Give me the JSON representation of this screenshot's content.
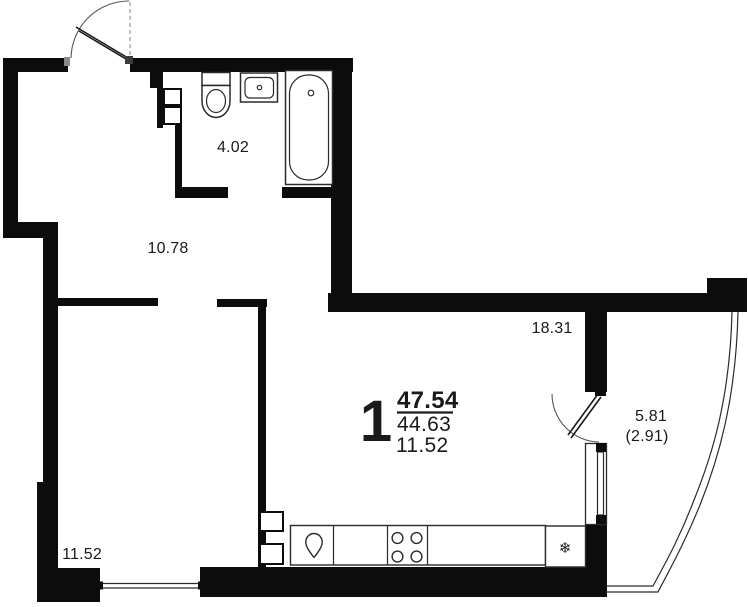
{
  "title": "apartment-floor-plan",
  "colors": {
    "wall": "#0c0c0c",
    "line": "#2b2b2b",
    "thin": "#444444",
    "bg": "#ffffff"
  },
  "rooms": {
    "bathroom": {
      "area": "4.02"
    },
    "hallway": {
      "area": "10.78"
    },
    "living_kitchen": {
      "area": "18.31"
    },
    "bedroom": {
      "area": "11.52"
    },
    "balcony": {
      "area": "5.81",
      "area_coeff": "(2.91)"
    }
  },
  "summary": {
    "rooms_count": "1",
    "total_area": "47.54",
    "living_area": "44.63",
    "room_area": "11.52"
  },
  "icons": {
    "fridge": "❄"
  }
}
